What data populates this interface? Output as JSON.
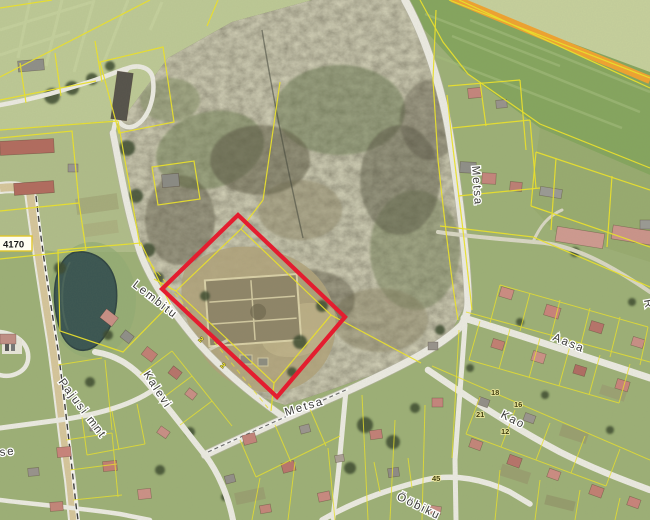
{
  "map": {
    "road_labels": [
      {
        "name": "metsa-south",
        "text": "Metsa"
      },
      {
        "name": "metsa-north",
        "text": "Metsa"
      },
      {
        "name": "aasa",
        "text": "Aasa"
      },
      {
        "name": "kao",
        "text": "Kao"
      },
      {
        "name": "oobiku",
        "text": "Ööbiku"
      },
      {
        "name": "kalevi",
        "text": "Kalevi"
      },
      {
        "name": "lembitu",
        "text": "Lembitu"
      },
      {
        "name": "pajusi-mnt",
        "text": "Pajusi mnt"
      }
    ],
    "route_badge": "4170",
    "parcel_numbers": [
      "18",
      "16",
      "21",
      "12",
      "45"
    ],
    "gate_marks": [
      "2",
      "2"
    ],
    "partial_labels": [
      "se",
      "R"
    ],
    "colors": {
      "parcel_highlight": "#e8182c",
      "cadastral_line": "#ece32a",
      "highway_road": "#f0a32f",
      "pond": "#3a5551"
    }
  }
}
